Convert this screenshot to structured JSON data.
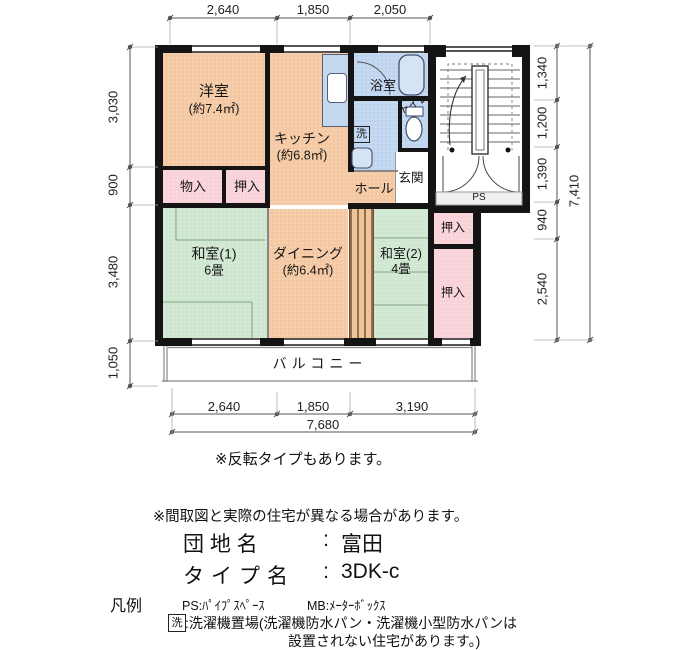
{
  "plan": {
    "rooms": {
      "western": {
        "name": "洋室",
        "area": "(約7.4㎡)"
      },
      "kitchen": {
        "name": "キッチン",
        "area": "(約6.8㎡)"
      },
      "bath": {
        "name": "浴室"
      },
      "toilet": {
        "name": "トイレ"
      },
      "laundry": {
        "name": "洗"
      },
      "hall": {
        "name": "ホール"
      },
      "entrance": {
        "name": "玄関"
      },
      "storage": {
        "name": "物入"
      },
      "closet_upper": {
        "name": "押入"
      },
      "japanese1": {
        "name": "和室(1)",
        "area": "6畳"
      },
      "dining": {
        "name": "ダイニング",
        "area": "(約6.4㎡)"
      },
      "japanese2": {
        "name": "和室(2)",
        "area": "4畳"
      },
      "closet_right_top": {
        "name": "押入"
      },
      "closet_right_bottom": {
        "name": "押入"
      },
      "balcony": {
        "name": "バルコニー"
      },
      "pipe_space": {
        "name": "PS"
      }
    },
    "dims": {
      "top": [
        "2,640",
        "1,850",
        "2,050"
      ],
      "left": [
        "3,030",
        "900",
        "3,480",
        "1,050"
      ],
      "right": [
        "1,340",
        "1,200",
        "1,390",
        "940",
        "2,540"
      ],
      "right_total": "7,410",
      "bottom": [
        "2,640",
        "1,850",
        "3,190"
      ],
      "bottom_total": "7,680"
    },
    "colors": {
      "warm_room": "#f4c8a2",
      "tatami_room": "#cfe7d0",
      "closet": "#f8d2d8",
      "wet_area": "#bfd4ee",
      "wall": "#141414"
    }
  },
  "notes": {
    "reversed": "※反転タイプもあります。",
    "disclaimer": "※間取図と実際の住宅が異なる場合があります。"
  },
  "info": {
    "estate_label": "団 地 名",
    "colon": ":",
    "estate_value": "富田",
    "type_label": "タイプ名",
    "type_value": "3DK-c"
  },
  "legend": {
    "title": "凡例",
    "ps_entry": "PS:ﾊﾟｲﾌﾟｽﾍﾟｰｽ",
    "mb_entry": "MB:ﾒｰﾀｰﾎﾞｯｸｽ",
    "laundry_mark": "洗",
    "laundry_entry": ":洗濯機置場(洗濯機防水パン・洗濯機小型防水パンは",
    "laundry_entry2": "設置されない住宅があります。)"
  }
}
